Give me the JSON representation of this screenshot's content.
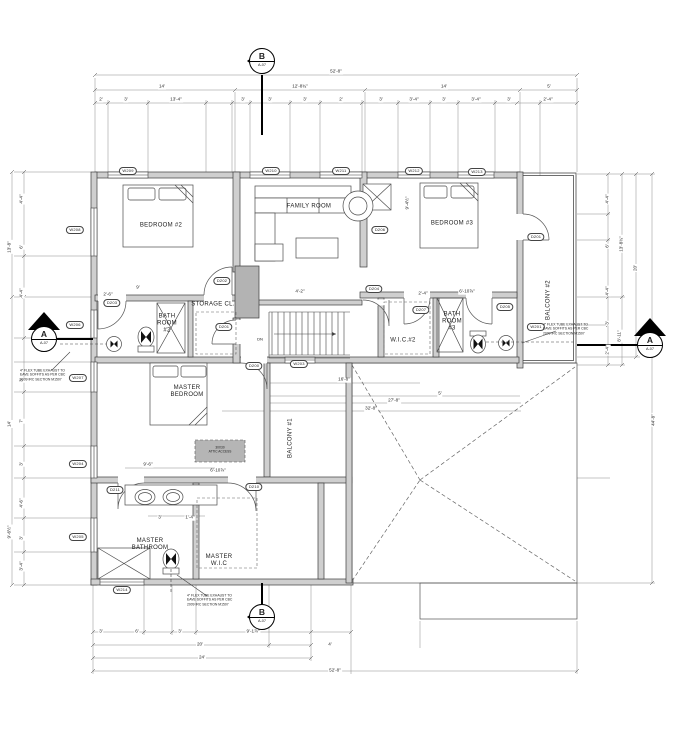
{
  "drawing": {
    "type": "architectural-floor-plan",
    "sheet_ref": "A-07",
    "colors": {
      "wall_fill": "#cfcfcf",
      "chase_fill": "#b3b3b3",
      "line": "#3c3c3c",
      "background": "#ffffff"
    }
  },
  "labels": {
    "rooms": [
      {
        "t": "BEDROOM #2",
        "x": 161,
        "y": 226,
        "n": "room-label-bedroom-2"
      },
      {
        "t": "FAMILY ROOM",
        "x": 309,
        "y": 207,
        "n": "room-label-family-room"
      },
      {
        "t": "BEDROOM #3",
        "x": 452,
        "y": 224,
        "n": "room-label-bedroom-3"
      },
      {
        "t": "BALCONY #2",
        "x": 549,
        "y": 300,
        "rot": -90,
        "n": "room-label-balcony-2"
      },
      {
        "t": "BATH\nROOM\n#2",
        "x": 167,
        "y": 324,
        "n": "room-label-bath-room-2"
      },
      {
        "t": "STORAGE CL.",
        "x": 213,
        "y": 305,
        "n": "room-label-storage-closet"
      },
      {
        "t": "W.I.C.#2",
        "x": 403,
        "y": 341,
        "n": "room-label-wic-2"
      },
      {
        "t": "BATH\nROOM\n#3",
        "x": 452,
        "y": 322,
        "n": "room-label-bath-room-3"
      },
      {
        "t": "MASTER\nBEDROOM",
        "x": 187,
        "y": 392,
        "n": "room-label-master-bedroom"
      },
      {
        "t": "BALCONY #1",
        "x": 291,
        "y": 438,
        "rot": -90,
        "n": "room-label-balcony-1"
      },
      {
        "t": "MASTER\nBATHROOM",
        "x": 150,
        "y": 545,
        "n": "room-label-master-bathroom"
      },
      {
        "t": "MASTER\nW.I.C",
        "x": 219,
        "y": 561,
        "n": "room-label-master-wic"
      }
    ],
    "misc": [
      {
        "t": "DN",
        "x": 260,
        "y": 340,
        "n": "stair-dn-label"
      },
      {
        "t": "30X30\nATTIC ACCESS",
        "x": 220,
        "y": 450,
        "n": "attic-access-label",
        "cls": "attic"
      }
    ],
    "tags": [
      {
        "t": "W209",
        "x": 128,
        "y": 171,
        "n": "window-tag-w209"
      },
      {
        "t": "W210",
        "x": 271,
        "y": 171,
        "n": "window-tag-w210"
      },
      {
        "t": "W211",
        "x": 341,
        "y": 171,
        "n": "window-tag-w211"
      },
      {
        "t": "W212",
        "x": 414,
        "y": 171,
        "n": "window-tag-w212"
      },
      {
        "t": "W213",
        "x": 477,
        "y": 172,
        "n": "window-tag-w213"
      },
      {
        "t": "W208",
        "x": 75,
        "y": 230,
        "n": "window-tag-w208"
      },
      {
        "t": "W206",
        "x": 75,
        "y": 325,
        "n": "window-tag-w206"
      },
      {
        "t": "W207",
        "x": 78,
        "y": 378,
        "n": "window-tag-w207"
      },
      {
        "t": "W204",
        "x": 78,
        "y": 464,
        "n": "window-tag-w204"
      },
      {
        "t": "W205",
        "x": 78,
        "y": 537,
        "n": "window-tag-w205"
      },
      {
        "t": "W214",
        "x": 122,
        "y": 590,
        "n": "window-tag-w214"
      },
      {
        "t": "W203",
        "x": 299,
        "y": 364,
        "n": "window-tag-w203"
      },
      {
        "t": "W201",
        "x": 536,
        "y": 327,
        "n": "window-tag-w201"
      },
      {
        "t": "D203",
        "x": 112,
        "y": 303,
        "n": "door-tag-d203"
      },
      {
        "t": "D202",
        "x": 222,
        "y": 281,
        "n": "door-tag-d202"
      },
      {
        "t": "D201",
        "x": 224,
        "y": 327,
        "n": "door-tag-d201"
      },
      {
        "t": "D200",
        "x": 254,
        "y": 366,
        "n": "door-tag-d200"
      },
      {
        "t": "D201",
        "x": 536,
        "y": 237,
        "n": "door-tag-d201-balcony"
      },
      {
        "t": "D206",
        "x": 380,
        "y": 230,
        "n": "door-tag-d206"
      },
      {
        "t": "D204",
        "x": 374,
        "y": 289,
        "n": "door-tag-d204"
      },
      {
        "t": "D205",
        "x": 505,
        "y": 307,
        "n": "door-tag-d205"
      },
      {
        "t": "D207",
        "x": 421,
        "y": 310,
        "n": "door-tag-d207"
      },
      {
        "t": "D210",
        "x": 254,
        "y": 487,
        "n": "door-tag-d210"
      },
      {
        "t": "D211",
        "x": 115,
        "y": 490,
        "n": "door-tag-d211"
      }
    ],
    "dims": [
      {
        "t": "52'-8\"",
        "x": 336,
        "y": 72
      },
      {
        "t": "14'",
        "x": 162,
        "y": 87
      },
      {
        "t": "12'-8¾\"",
        "x": 300,
        "y": 87
      },
      {
        "t": "14'",
        "x": 444,
        "y": 87
      },
      {
        "t": "5'",
        "x": 549,
        "y": 87
      },
      {
        "t": "2'",
        "x": 101,
        "y": 100
      },
      {
        "t": "3'",
        "x": 126,
        "y": 100
      },
      {
        "t": "13'-4\"",
        "x": 176,
        "y": 100
      },
      {
        "t": "3'",
        "x": 243,
        "y": 100
      },
      {
        "t": "3'",
        "x": 270,
        "y": 100
      },
      {
        "t": "3'",
        "x": 305,
        "y": 100
      },
      {
        "t": "2'",
        "x": 341,
        "y": 100
      },
      {
        "t": "3'",
        "x": 381,
        "y": 100
      },
      {
        "t": "3'-4\"",
        "x": 414,
        "y": 100
      },
      {
        "t": "3'",
        "x": 444,
        "y": 100
      },
      {
        "t": "3'-4\"",
        "x": 476,
        "y": 100
      },
      {
        "t": "3'",
        "x": 509,
        "y": 100
      },
      {
        "t": "2'-4\"",
        "x": 548,
        "y": 100
      },
      {
        "t": "3'",
        "x": 101,
        "y": 632
      },
      {
        "t": "6'",
        "x": 137,
        "y": 632
      },
      {
        "t": "3'",
        "x": 180,
        "y": 632
      },
      {
        "t": "9'-1⅞\"",
        "x": 253,
        "y": 632
      },
      {
        "t": "20'",
        "x": 200,
        "y": 645
      },
      {
        "t": "4'",
        "x": 330,
        "y": 645
      },
      {
        "t": "24'",
        "x": 202,
        "y": 658
      },
      {
        "t": "52'-8\"",
        "x": 335,
        "y": 671
      },
      {
        "t": "13'-8\"",
        "x": 10,
        "y": 247,
        "rot": -90
      },
      {
        "t": "14'",
        "x": 10,
        "y": 424,
        "rot": -90
      },
      {
        "t": "9'-6½\"",
        "x": 10,
        "y": 532,
        "rot": -90
      },
      {
        "t": "4'-4\"",
        "x": 22,
        "y": 199,
        "rot": -90
      },
      {
        "t": "6'",
        "x": 22,
        "y": 247,
        "rot": -90
      },
      {
        "t": "4'-4\"",
        "x": 22,
        "y": 293,
        "rot": -90
      },
      {
        "t": "3'",
        "x": 22,
        "y": 380,
        "rot": -90
      },
      {
        "t": "7'",
        "x": 22,
        "y": 421,
        "rot": -90
      },
      {
        "t": "3'",
        "x": 22,
        "y": 464,
        "rot": -90
      },
      {
        "t": "4'-6\"",
        "x": 22,
        "y": 503,
        "rot": -90
      },
      {
        "t": "3'",
        "x": 22,
        "y": 538,
        "rot": -90
      },
      {
        "t": "3'-4\"",
        "x": 22,
        "y": 566,
        "rot": -90
      },
      {
        "t": "13'-8¾\"",
        "x": 622,
        "y": 244,
        "rot": -90
      },
      {
        "t": "20'",
        "x": 636,
        "y": 268,
        "rot": -90
      },
      {
        "t": "44'-8\"",
        "x": 654,
        "y": 420,
        "rot": -90
      },
      {
        "t": "4'-4\"",
        "x": 608,
        "y": 199,
        "rot": -90
      },
      {
        "t": "6'",
        "x": 608,
        "y": 246,
        "rot": -90
      },
      {
        "t": "4'-4\"",
        "x": 608,
        "y": 291,
        "rot": -90
      },
      {
        "t": "3'",
        "x": 608,
        "y": 323,
        "rot": -90
      },
      {
        "t": "8'-11\"",
        "x": 620,
        "y": 336,
        "rot": -90
      },
      {
        "t": "2'-4\"",
        "x": 608,
        "y": 350,
        "rot": -90
      },
      {
        "t": "9'",
        "x": 138,
        "y": 288
      },
      {
        "t": "2'-6\"",
        "x": 108,
        "y": 295
      },
      {
        "t": "4'-2\"",
        "x": 300,
        "y": 292
      },
      {
        "t": "2'-4\"",
        "x": 423,
        "y": 294
      },
      {
        "t": "6'-10⅞\"",
        "x": 467,
        "y": 292
      },
      {
        "t": "16'-8\"",
        "x": 344,
        "y": 380
      },
      {
        "t": "5'",
        "x": 440,
        "y": 394
      },
      {
        "t": "27'-8\"",
        "x": 394,
        "y": 401
      },
      {
        "t": "32'-8\"",
        "x": 371,
        "y": 409
      },
      {
        "t": "9'-6\"",
        "x": 148,
        "y": 465
      },
      {
        "t": "6'-10⅞\"",
        "x": 218,
        "y": 471
      },
      {
        "t": "9'-4½\"",
        "x": 408,
        "y": 203,
        "rot": -90
      },
      {
        "t": "3'",
        "x": 160,
        "y": 518
      },
      {
        "t": "1'-4\"",
        "x": 190,
        "y": 518
      }
    ],
    "notes": [
      {
        "t": "4\" FLEX TUBE EXHAUST TO\nEAVE SOFFITS AS PER CBC\n2009 IRC SECTION M1507",
        "x": 47,
        "y": 375,
        "n": "exhaust-note-left"
      },
      {
        "t": "4\" FLEX TUBE EXHAUST TO\nEAVE SOFFITS AS PER CBC\n2009 IRC SECTION M1507",
        "x": 570,
        "y": 329,
        "n": "exhaust-note-right"
      },
      {
        "t": "4\" FLEX TUBE EXHAUST TO\nEAVE SOFFITS AS PER CBC\n2009 IRC SECTION M1507",
        "x": 214,
        "y": 600,
        "n": "exhaust-note-bottom"
      }
    ],
    "markers": [
      {
        "letter": "B",
        "sheet": "A-07",
        "x": 262,
        "y": 61,
        "n": "section-marker-b-top"
      },
      {
        "letter": "B",
        "sheet": "A-07",
        "x": 262,
        "y": 617,
        "n": "section-marker-b-bottom"
      },
      {
        "letter": "A",
        "sheet": "A-07",
        "x": 44,
        "y": 339,
        "n": "section-marker-a-left"
      },
      {
        "letter": "A",
        "sheet": "A-07",
        "x": 650,
        "y": 345,
        "n": "section-marker-a-right"
      }
    ]
  }
}
